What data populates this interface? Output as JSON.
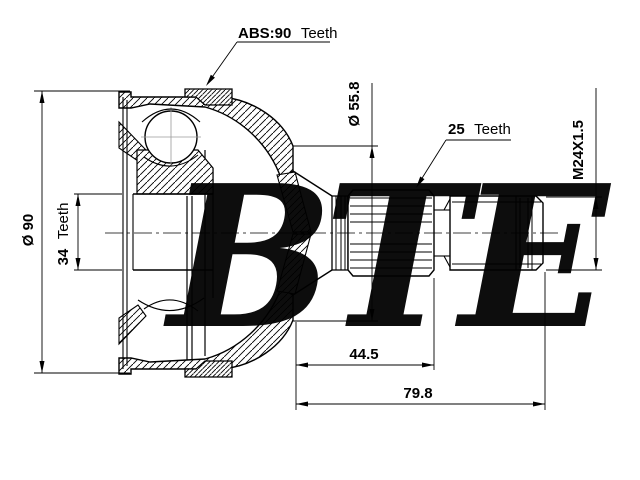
{
  "drawing": {
    "type": "technical-cross-section",
    "subject": "CV joint / drive shaft outer joint",
    "background": "#ffffff",
    "line_color": "#000000",
    "watermark_color": "#b4b4b4"
  },
  "watermark": {
    "text": "BTE"
  },
  "callouts": {
    "abs": {
      "value": "ABS:90",
      "word": "Teeth"
    },
    "outer_spline": {
      "value": "25",
      "word": "Teeth"
    }
  },
  "dimensions": {
    "outer_diameter": {
      "label": "Ø 90"
    },
    "inner_spline": {
      "value": "34",
      "word": "Teeth"
    },
    "housing_rear_diameter": {
      "label": "Ø 55.8"
    },
    "thread": {
      "label": "M24X1.5"
    },
    "spline_length": {
      "label": "44.5"
    },
    "total_length": {
      "label": "79.8"
    }
  }
}
